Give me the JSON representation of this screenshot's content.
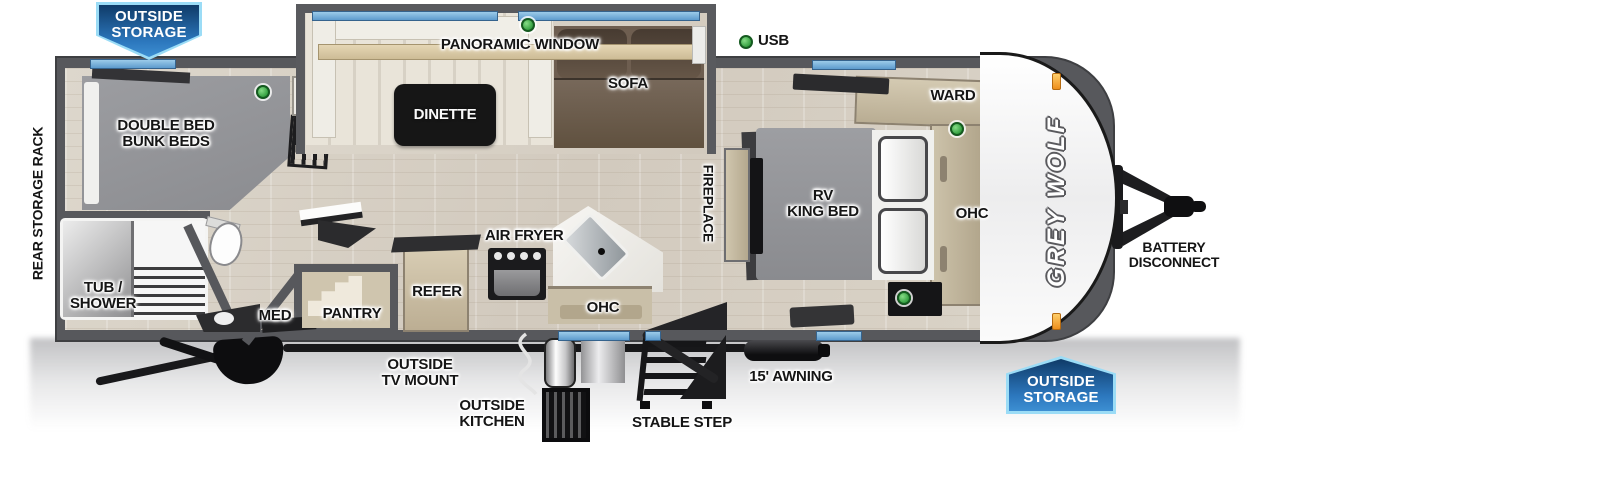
{
  "title": "Grey Wolf travel trailer floor plan",
  "badges": {
    "rear_outside_storage": {
      "line1": "OUTSIDE",
      "line2": "STORAGE"
    },
    "front_outside_storage": {
      "line1": "OUTSIDE",
      "line2": "STORAGE"
    }
  },
  "exterior": {
    "rear_storage_rack": "REAR STORAGE RACK",
    "usb_legend": "USB",
    "outside_tv_mount": {
      "line1": "OUTSIDE",
      "line2": "TV MOUNT"
    },
    "outside_kitchen": {
      "line1": "OUTSIDE",
      "line2": "KITCHEN"
    },
    "stable_step": "STABLE STEP",
    "awning": "15' AWNING",
    "battery_disconnect": {
      "line1": "BATTERY",
      "line2": "DISCONNECT"
    },
    "brand_logo": "GREY WOLF"
  },
  "rooms": {
    "bunk_room": {
      "label": {
        "line1": "DOUBLE BED",
        "line2": "BUNK BEDS"
      }
    },
    "bathroom": {
      "tub_shower": {
        "line1": "TUB /",
        "line2": "SHOWER"
      },
      "med": "MED"
    },
    "kitchen": {
      "pantry": "PANTRY",
      "refer": "REFER",
      "air_fryer": "AIR FRYER",
      "ohc": "OHC"
    },
    "living": {
      "dinette": "DINETTE",
      "panoramic_window": "PANORAMIC WINDOW",
      "sofa": "SOFA",
      "fireplace": "FIREPLACE"
    },
    "bedroom": {
      "bed": {
        "line1": "RV",
        "line2": "KING BED"
      },
      "ward": "WARD",
      "ohc": "OHC"
    }
  },
  "colors": {
    "badge_blue_dark": "#0f3b68",
    "badge_blue_light": "#3d8fd2",
    "badge_border_blue": "#9bdcf6",
    "wall_gray": "#57585c",
    "floor_wood": "#d8d1c5",
    "window_blue": "#74b0dc",
    "usb_green": "#2f9c3c",
    "cabinet_tan": "#c9bfa8",
    "sofa_brown": "#6e5e50",
    "mattress_gray": "#96979b",
    "clearance_marker_orange": "#ef8f1c"
  }
}
